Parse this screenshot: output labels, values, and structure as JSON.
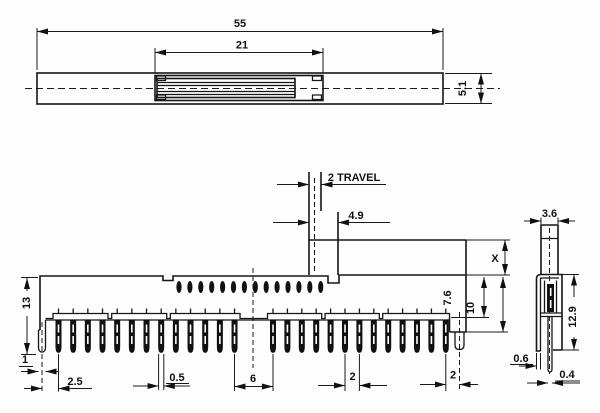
{
  "title": "slide switch technical drawing",
  "top_view": {
    "dim_total": "55",
    "dim_slider": "21",
    "dim_height": "5.1"
  },
  "front_view": {
    "dim_travel": "2 TRAVEL",
    "dim_stem": "4.9",
    "dim_height": "13",
    "dim_x": "X",
    "dim_upper": "7.6",
    "dim_lower": "10",
    "dim_foot": "1",
    "dim_foot_pin": "2.5",
    "dim_pin": "0.5",
    "dim_gap": "6",
    "dim_pitch": "2",
    "dim_end": "2",
    "pin_count_left": 13,
    "pin_count_right": 13,
    "contact_dot_count": 14
  },
  "side_view": {
    "dim_width": "3.6",
    "dim_height": "12.9",
    "dim_wall": "0.6",
    "dim_pin": "0.4"
  }
}
